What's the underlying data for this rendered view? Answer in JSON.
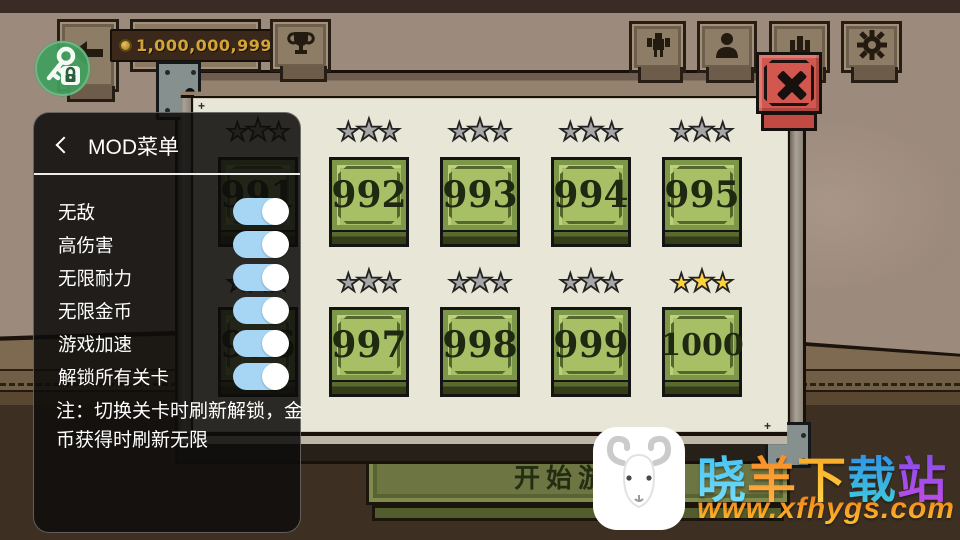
{
  "hud": {
    "coins": "1,000,000,999",
    "icons": {
      "back": "left-arrow",
      "coin": "gold-coin",
      "trophy": "trophy",
      "character": "character-sprite",
      "profile": "person-bust",
      "ranking": "crown",
      "settings": "gear",
      "close": "x-cross",
      "mod_fab": "key-and-lock"
    }
  },
  "mod_menu": {
    "title": "MOD菜单",
    "items": [
      {
        "label": "无敌",
        "enabled": true
      },
      {
        "label": "高伤害",
        "enabled": true
      },
      {
        "label": "无限耐力",
        "enabled": true
      },
      {
        "label": "无限金币",
        "enabled": true
      },
      {
        "label": "游戏加速",
        "enabled": true
      },
      {
        "label": "解锁所有关卡",
        "enabled": true
      }
    ],
    "note": "注：切换关卡时刷新解锁，金币获得时刷新无限"
  },
  "levels": {
    "star_char": "★",
    "rows": [
      {
        "tiles": [
          {
            "num": "991",
            "stars": "gray"
          },
          {
            "num": "992",
            "stars": "gray"
          },
          {
            "num": "993",
            "stars": "gray"
          },
          {
            "num": "994",
            "stars": "gray"
          },
          {
            "num": "995",
            "stars": "gray"
          }
        ]
      },
      {
        "tiles": [
          {
            "num": "996",
            "stars": "gray"
          },
          {
            "num": "997",
            "stars": "gray"
          },
          {
            "num": "998",
            "stars": "gray"
          },
          {
            "num": "999",
            "stars": "gray"
          },
          {
            "num": "1000",
            "stars": "gold"
          }
        ]
      }
    ],
    "start_button": "开始游戏"
  },
  "watermark": {
    "site_chars": [
      {
        "c": "晓",
        "from": "#38bdf0",
        "to": "#7fe0fb"
      },
      {
        "c": "羊",
        "from": "#f5831d",
        "to": "#ffb74a"
      },
      {
        "c": "下",
        "from": "#f79f18",
        "to": "#ffd94e"
      },
      {
        "c": "载",
        "from": "#2b85e8",
        "to": "#43d2dc"
      },
      {
        "c": "站",
        "from": "#7a4cf0",
        "to": "#c44fe2"
      }
    ],
    "url": "www.xfhygs.com",
    "url_from": "#f07a12",
    "url_to": "#ffc233"
  },
  "colors": {
    "toggle_on": "#a6d6f4",
    "star_gray": "#a6a6a6",
    "star_gold": "#ffd23c",
    "close_red": "#d2574f",
    "fab_green": "#3f9e5d",
    "panel_beige": "#e8e6d7",
    "tile_green": "#a7c065"
  }
}
